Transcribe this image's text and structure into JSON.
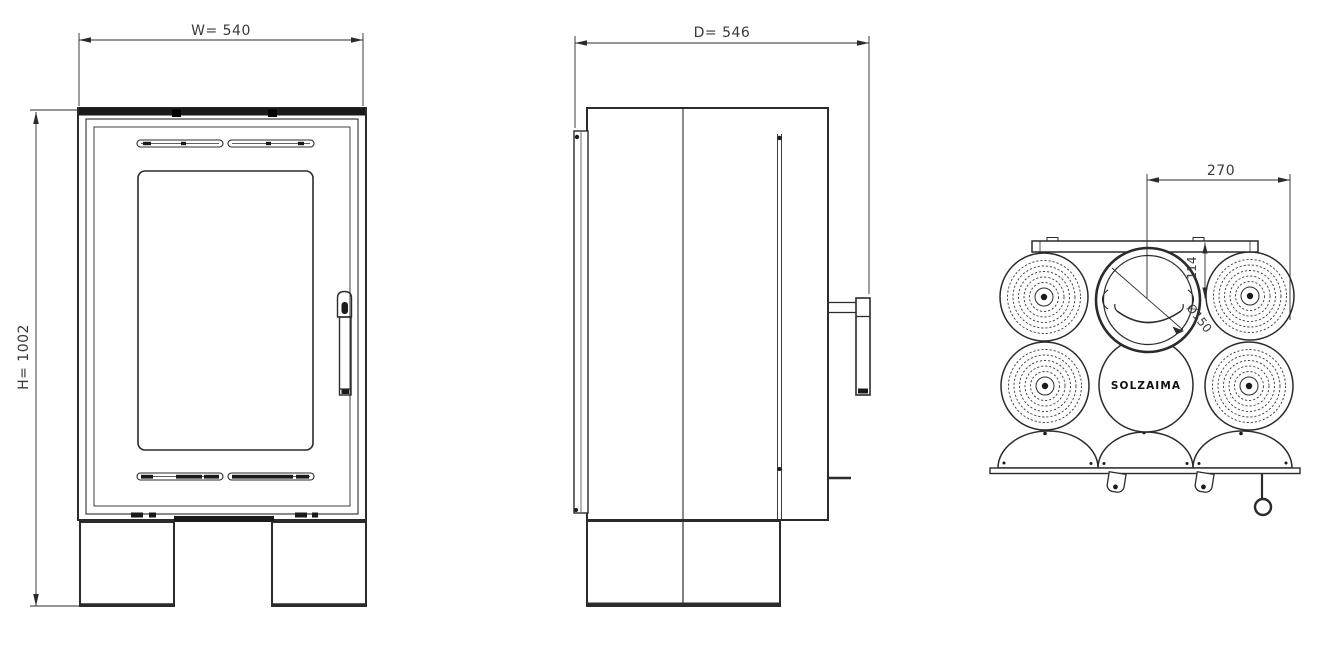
{
  "colors": {
    "line": "#2b2b2b",
    "dim_text": "#3a3a3a",
    "dark_fill": "#1a1a1a",
    "background": "#ffffff"
  },
  "front_view": {
    "width_dim": "W= 540",
    "height_dim": "H= 1002"
  },
  "side_view": {
    "depth_dim": "D= 546"
  },
  "top_view": {
    "half_width_dim": "270",
    "flue_setback_dim": "114",
    "flue_diameter_dim": "Ø150",
    "brand": "SOLZAIMA"
  }
}
